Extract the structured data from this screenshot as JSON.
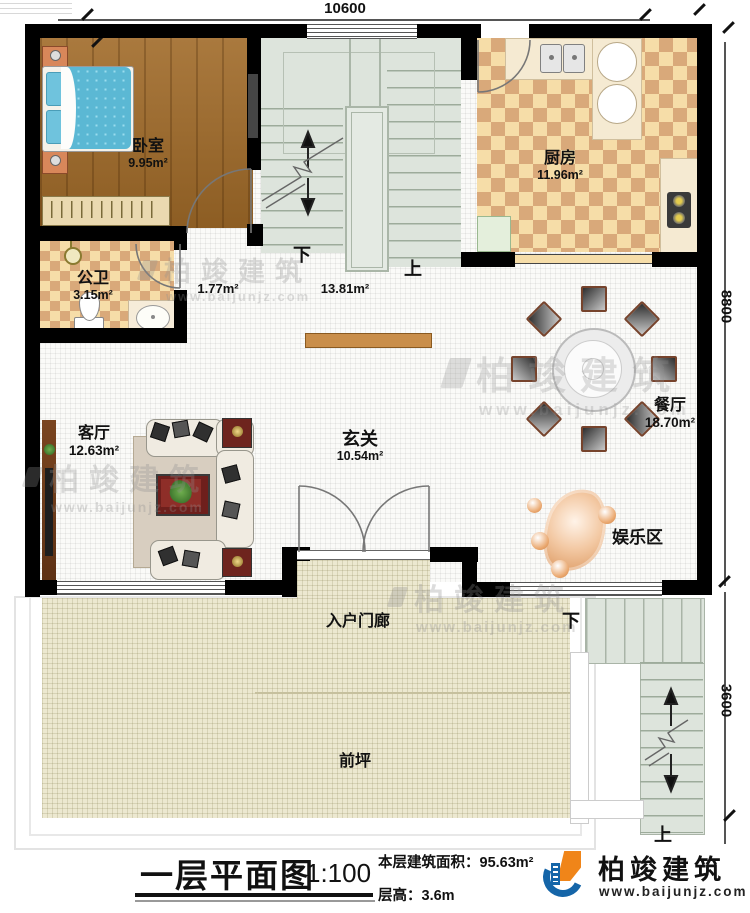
{
  "dims": {
    "top": "10600",
    "right_upper": "8800",
    "right_lower": "3600"
  },
  "rooms": {
    "bedroom": {
      "name": "卧室",
      "area": "9.95m²"
    },
    "kitchen": {
      "name": "厨房",
      "area": "11.96m²"
    },
    "bathroom": {
      "name": "公卫",
      "area": "3.15m²"
    },
    "hall": {
      "area": "1.77m²"
    },
    "stairwell": {
      "area": "13.81m²"
    },
    "foyer": {
      "name": "玄关",
      "area": "10.54m²"
    },
    "dining": {
      "name": "餐厅",
      "area": "18.70m²"
    },
    "living": {
      "name": "客厅",
      "area": "12.63m²"
    },
    "entertainment": {
      "name": "娱乐区"
    },
    "porch": {
      "name": "入户门廊"
    },
    "yard": {
      "name": "前坪"
    }
  },
  "stairs": {
    "down": "下",
    "up": "上"
  },
  "title_block": {
    "title": "一层平面图",
    "scale": "1:100",
    "area_label": "本层建筑面积：",
    "area_value": "95.63m²",
    "height_label": "层高：",
    "height_value": "3.6m"
  },
  "brand": {
    "name": "柏竣建筑",
    "website": "www.baijunjz.com"
  },
  "colors": {
    "wall": "#000000",
    "wood_floor": "#a06a28",
    "kitchen_tile": "#d9a97a",
    "yard": "#ece8d0",
    "stair": "#dde4dc",
    "brand_blue": "#1565a8",
    "brand_orange": "#f08519"
  }
}
